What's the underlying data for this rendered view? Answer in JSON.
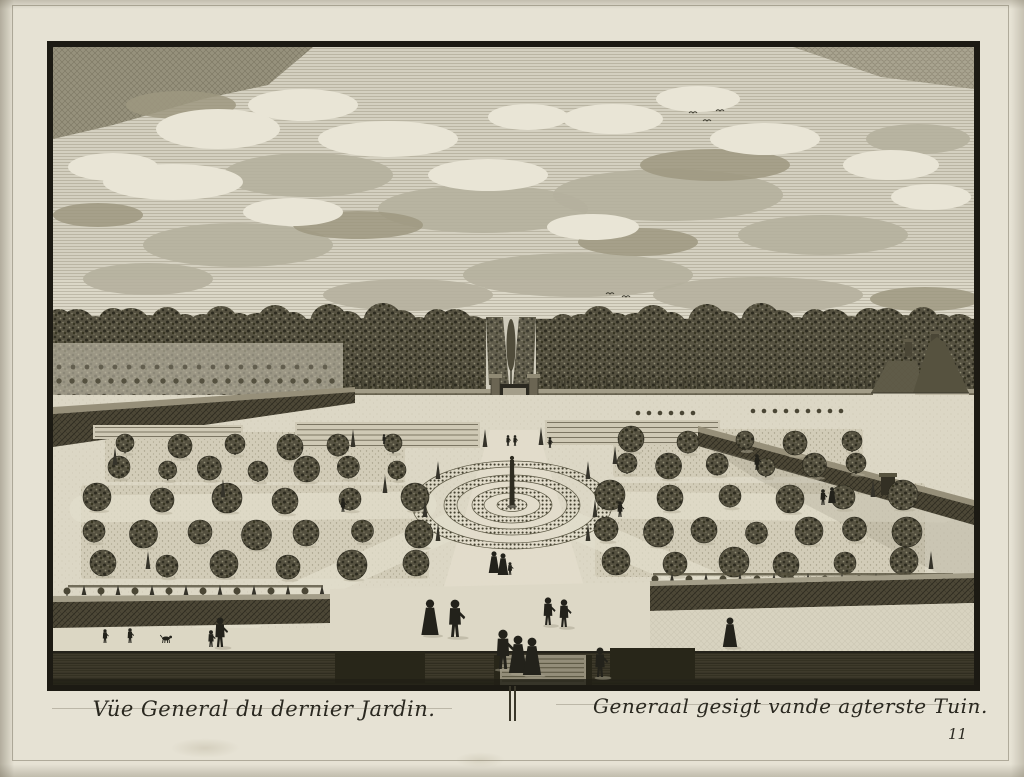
{
  "print": {
    "caption_left": "Vüe General du dernier Jardin.",
    "caption_right": "Generaal gesigt vande agterste Tuin.",
    "plate_number": "11",
    "colors": {
      "paper": "#e6e2d4",
      "ink": "#211f18",
      "sky": "#d4d0c0",
      "foliage": "#555140"
    },
    "icons": {
      "plate_divider": "double-vertical-line"
    }
  }
}
